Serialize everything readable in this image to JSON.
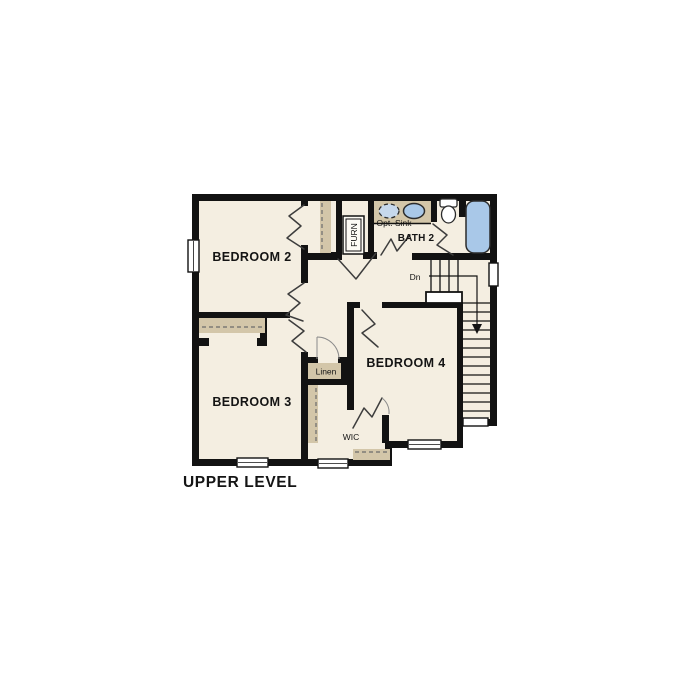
{
  "plan_title": "UPPER LEVEL",
  "rooms": {
    "bedroom2": "BEDROOM 2",
    "bedroom3": "BEDROOM 3",
    "bedroom4": "BEDROOM 4",
    "bath2": "BATH 2"
  },
  "annotations": {
    "opt_sink": "Opt. Sink",
    "furnace": "FURN",
    "linen": "Linen",
    "wic": "WIC",
    "stairs_down": "Dn"
  },
  "colors": {
    "wall": "#121212",
    "floor": "#f4eee1",
    "casework": "#d3c6a9",
    "fixture": "#a9c8e8",
    "background": "#ffffff",
    "door_line": "#3d3d3d",
    "arc_line": "#8a8a8a"
  }
}
